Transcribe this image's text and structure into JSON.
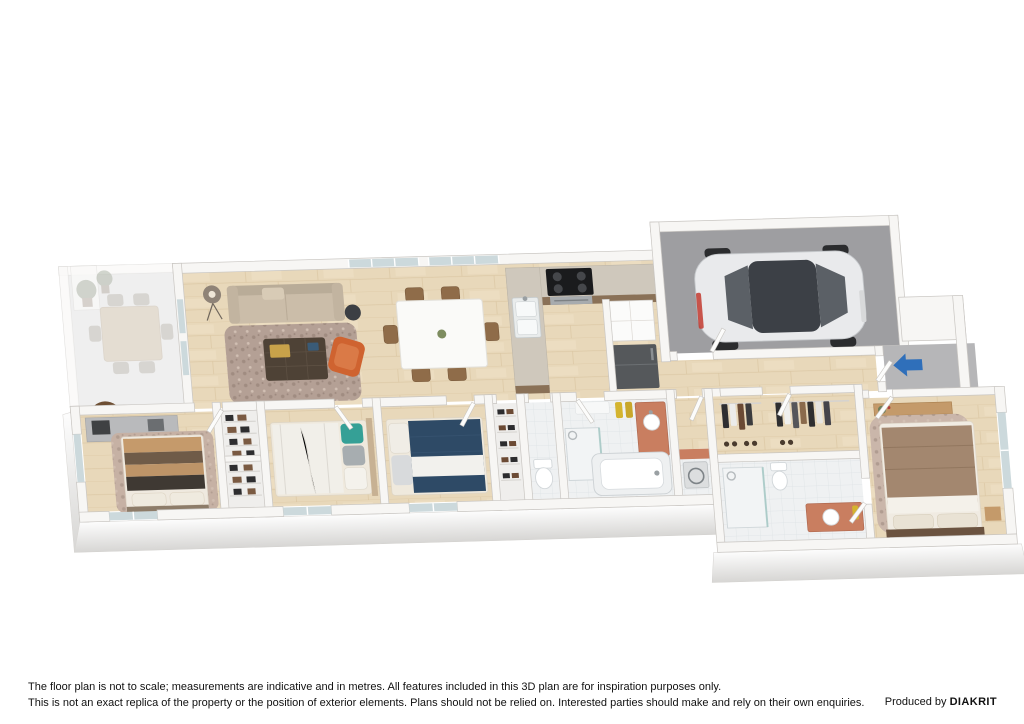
{
  "page": {
    "width": 1024,
    "height": 724,
    "background": "#ffffff"
  },
  "footer": {
    "disclaimer_line1": "The floor plan is not to scale; measurements are indicative and in metres. All features included in this 3D plan are for inspiration purposes only.",
    "disclaimer_line2": "This is not an exact replica of the property or the position of exterior elements. Plans should not be relied on. Interested parties should make and rely on their own enquiries.",
    "credit_prefix": "Produced by",
    "credit_brand": "DIAKRIT"
  },
  "plan": {
    "type": "3d-floorplan-cutaway",
    "entry_indicator": {
      "shape": "arrow",
      "direction": "left",
      "color": "#2f6fba"
    },
    "rooms": [
      "alfresco-deck",
      "living-room",
      "dining-area",
      "kitchen",
      "pantry",
      "garage",
      "hallway",
      "entry-porch",
      "bedroom-1",
      "built-in-robes",
      "bedroom-2",
      "bedroom-3",
      "linen-closet",
      "wc",
      "bathroom",
      "laundry",
      "walk-in-robe",
      "ensuite",
      "master-bedroom"
    ],
    "furniture": [
      "outdoor-dining-set",
      "potted-plants",
      "floor-lamp",
      "sofa",
      "area-rug",
      "coffee-table",
      "accent-armchair",
      "dining-table-with-6-chairs",
      "kitchen-peninsula-sink",
      "cooktop-and-oven",
      "refrigerator",
      "pantry-cupboard",
      "car",
      "desk-with-chair",
      "bed-brown-stripe",
      "bed-white-teal",
      "bed-navy",
      "wardrobe-shelving",
      "shoe-rack",
      "toilet",
      "shower",
      "bathtub",
      "vanity",
      "towels",
      "washing-machine",
      "hanging-clothes",
      "master-bed",
      "floating-shelf"
    ],
    "colors": {
      "wood_floor": "#e8d8ba",
      "garage_floor": "#9e9ea1",
      "porch_floor": "#b6b6b8",
      "tile_floor": "#eff1f2",
      "wall": "#f7f6f4",
      "wall_edge": "#c9c6c2",
      "rug": "#b4a095",
      "sofa": "#cbbda9",
      "accent_chair": "#cf6330",
      "navy_bedding": "#2e4a66",
      "teal_pillow": "#35a096",
      "vanity_terracotta": "#c97e60",
      "towel_yellow": "#d4b42f",
      "car_body": "#e9eaec",
      "entry_arrow": "#2f6fba"
    }
  }
}
